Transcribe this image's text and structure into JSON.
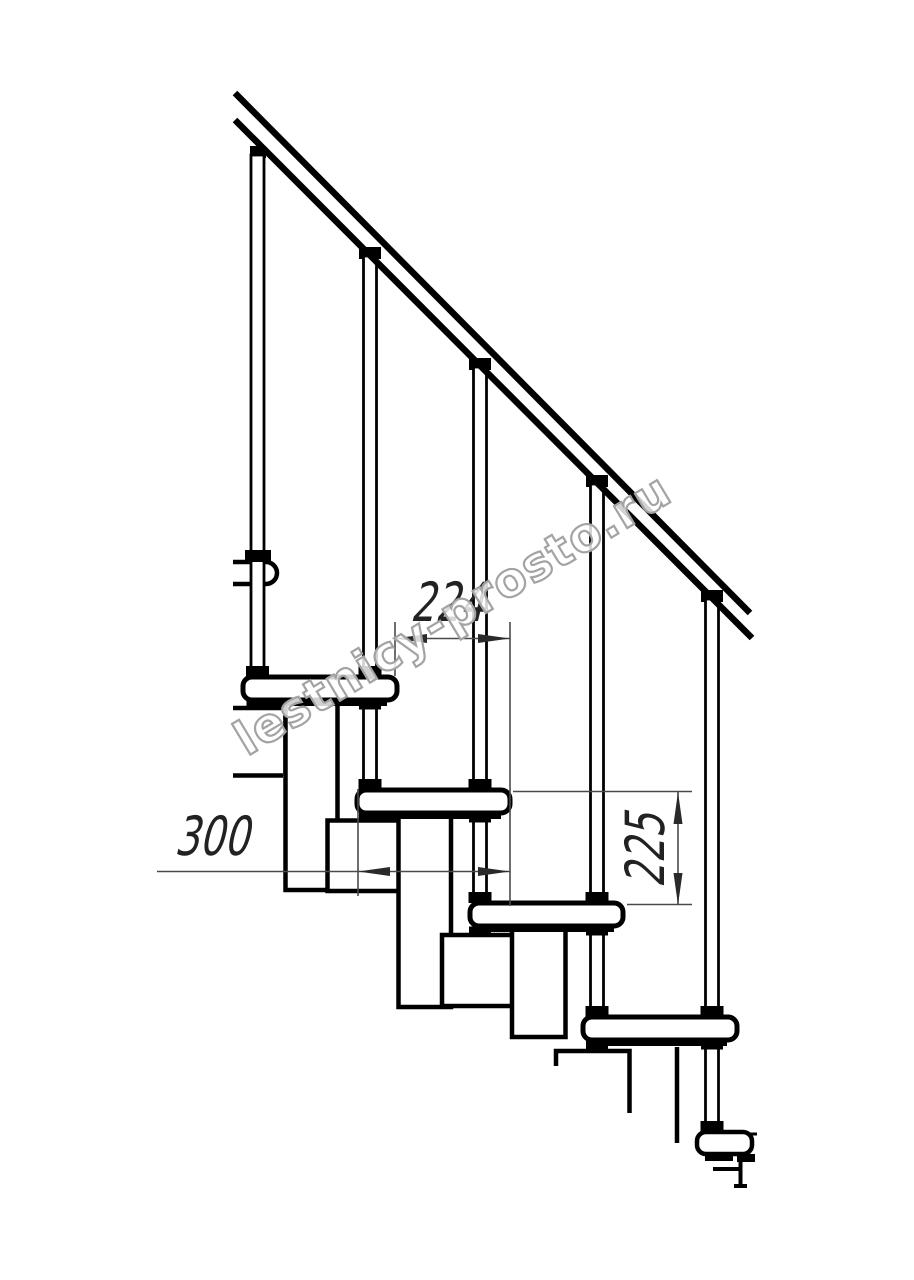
{
  "drawing_type": "staircase-side-view-technical-drawing",
  "dimensions": {
    "going": {
      "label": "224"
    },
    "tread_depth": {
      "label": "300"
    },
    "riser_height": {
      "label": "225"
    }
  },
  "watermark": {
    "text": "lestnicy-prosto.ru"
  },
  "colors": {
    "background": "#ffffff",
    "main_line": "#000000",
    "dimension_line": "#4a4a4a",
    "dimension_text": "#222222",
    "watermark_outline": "#a3a3a3"
  },
  "counts": {
    "treads_visible": 4,
    "balusters_visible": 5
  }
}
